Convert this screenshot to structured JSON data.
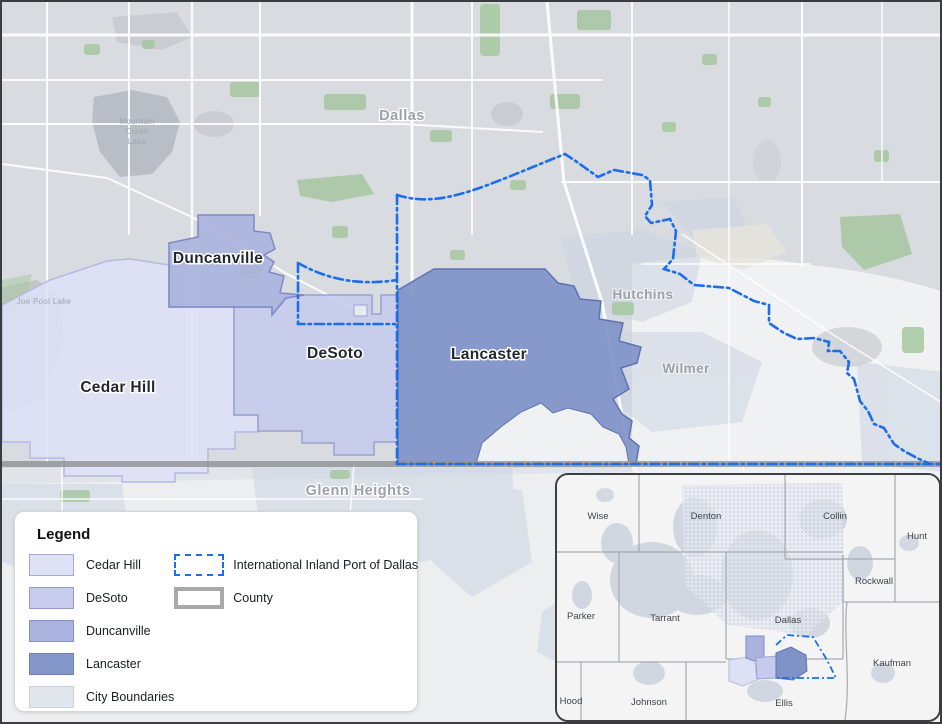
{
  "map": {
    "labels": {
      "dallas": "Dallas",
      "duncanville": "Duncanville",
      "cedar_hill": "Cedar Hill",
      "desoto": "DeSoto",
      "lancaster": "Lancaster",
      "hutchins": "Hutchins",
      "wilmer": "Wilmer",
      "glenn_heights": "Glenn Heights",
      "joe_pool_lake": "Joe Pool Lake",
      "mountain_creek_lake_lines": [
        "Mountain",
        "Creek",
        "Lake"
      ]
    }
  },
  "legend": {
    "title": "Legend",
    "items": [
      {
        "label": "Cedar Hill",
        "color": "#dfe2f6"
      },
      {
        "label": "DeSoto",
        "color": "#c7cbed"
      },
      {
        "label": "Duncanville",
        "color": "#aab4de"
      },
      {
        "label": "Lancaster",
        "color": "#8496c9"
      },
      {
        "label": "City Boundaries",
        "color": "#e2e7ee"
      }
    ],
    "line_items": [
      {
        "label": "International Inland Port of Dallas",
        "style": "blue-dash-dot-outline"
      },
      {
        "label": "County",
        "style": "gray-outline"
      }
    ]
  },
  "inset": {
    "counties": {
      "wise": "Wise",
      "denton": "Denton",
      "collin": "Collin",
      "hunt": "Hunt",
      "rockwall": "Rockwall",
      "parker": "Parker",
      "tarrant": "Tarrant",
      "dallas": "Dallas",
      "kaufman": "Kaufman",
      "hood": "Hood",
      "johnson": "Johnson",
      "ellis": "Ellis"
    }
  },
  "colors": {
    "base": "#d8dbdf",
    "light_area": "#f0f1f2",
    "city_patch": "#ccd5e2",
    "green": "#a6c7a0",
    "water": "#b9bdc6",
    "urban": "#c6c9cf",
    "road": "#ffffff",
    "cedar_hill": "#dee1f6",
    "cedar_hill_border": "#b4bae2",
    "desoto": "#c6cbee",
    "desoto_border": "#99a2d6",
    "duncanville": "#aab3de",
    "duncanville_border": "#7e8ac6",
    "lancaster": "#8093c8",
    "lancaster_border": "#5d73b2",
    "port_blue": "#1c6ee8",
    "county_gray": "#909294",
    "rail_orange": "#d2914f",
    "label_dark": "#23282e",
    "label_gray": "#9aa1a8",
    "inset_bg": "#f4f4f4",
    "inset_line": "#a6aab0",
    "inset_label": "#3f444a",
    "inset_urban": "#ccd2de"
  }
}
